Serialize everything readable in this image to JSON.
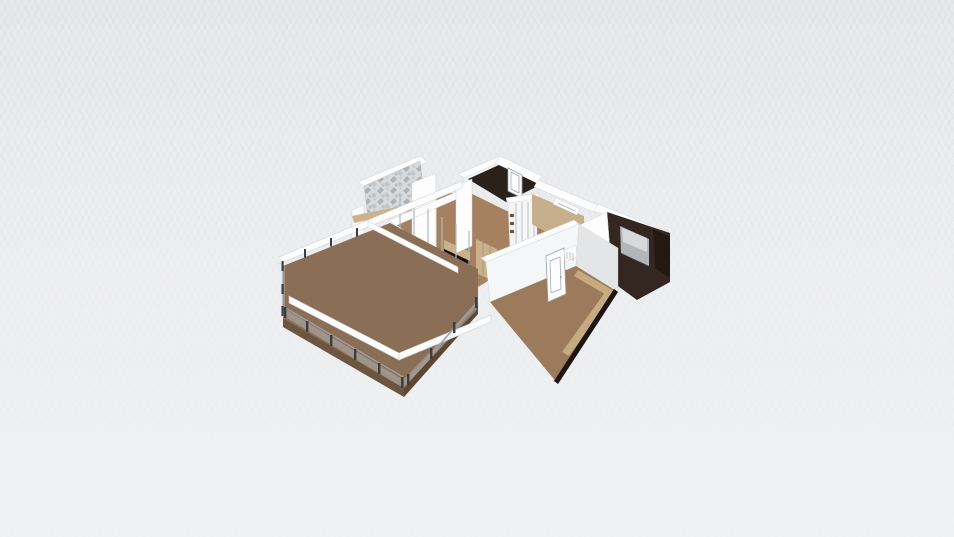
{
  "app": {
    "title": "3D Floor Plan View"
  },
  "canvas": {
    "width": 954,
    "height": 537
  },
  "colors": {
    "bg_top": "#e7e8ea",
    "bg_mid": "#edeef0",
    "bg_bottom": "#f0f1f2",
    "grid_line": "rgba(130,136,148,0.06)",
    "wall_white": "#fdfdfe",
    "wall_face": "#f5f6f7",
    "wall_side": "#e3e5e7",
    "wall_line": "#cfd2d5",
    "beam_shade": "#dcdee1",
    "deck_wood": "#8a6e55",
    "deck_plank": "rgba(58,38,22,0.38)",
    "deck_fascia": "#6d5540",
    "deck_fascia_dark": "#5d4733",
    "floor_wood": "#a5815f",
    "floor_wood2": "#9c7a5c",
    "floor_plank": "rgba(84,56,34,0.30)",
    "floor_tan": "#c7ae8d",
    "dark_floor": "#2b211b",
    "bedroom_floor": "#342721",
    "wardrobe_dark": "#221913",
    "bed_base": "#b3b6b8",
    "bed_top": "#d6d8da",
    "marble_bg": "#d8dbdd",
    "marble_dark": "#9ba1a5",
    "marble_mid": "#c0c5c8",
    "trim_tan": "#c8aa80",
    "ladder_tan": "#cdb28c",
    "ladder_rung": "rgba(90,70,45,0.55)",
    "glass": "rgba(203,216,226,0.35)",
    "mullion": "#b4bac0",
    "rail": "#9aa0a6",
    "post_dark": "#3a3d41",
    "tv_dark": "#16100c",
    "cab_tan": "#cbb089",
    "door_line": "#9aa0a4",
    "edge_dark": "#1c1511",
    "panel_line": "#7d8184",
    "shelf_item": "#6b5442"
  },
  "scene": {
    "elements": [
      {
        "id": "terrace-deck"
      },
      {
        "id": "pergola-frame"
      },
      {
        "id": "glass-railing"
      },
      {
        "id": "living-room"
      },
      {
        "id": "tv-unit"
      },
      {
        "id": "kitchen-unit"
      },
      {
        "id": "marble-bathroom"
      },
      {
        "id": "upper-bathroom"
      },
      {
        "id": "sliding-wardrobe"
      },
      {
        "id": "hallway"
      },
      {
        "id": "bedroom"
      },
      {
        "id": "bed"
      },
      {
        "id": "lower-room"
      },
      {
        "id": "interior-door"
      }
    ]
  }
}
